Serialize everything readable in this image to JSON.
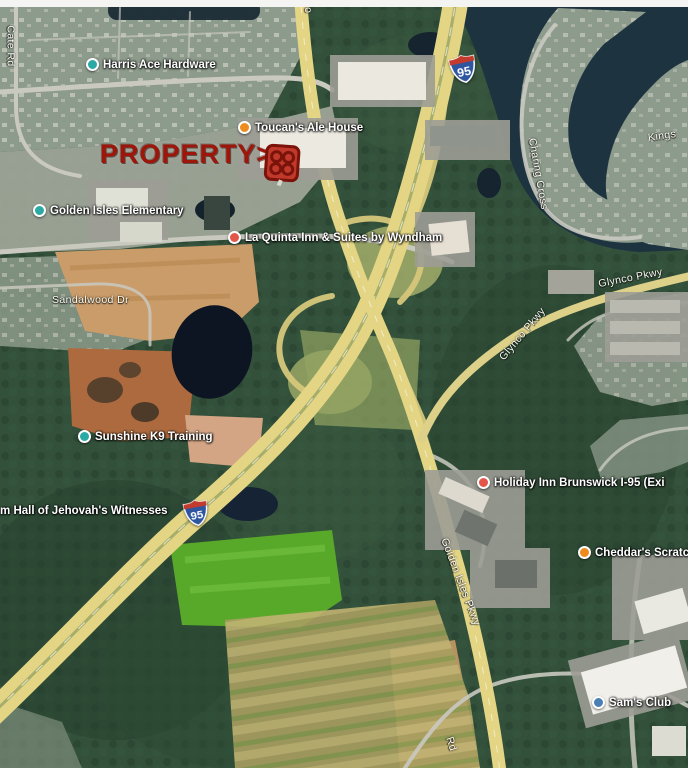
{
  "map_type": "satellite-aerial",
  "annotation": {
    "property_label": "PROPERTY>",
    "marker_icon": "red-pinwheel-badge"
  },
  "shield": {
    "route": "95",
    "icon": "interstate-shield"
  },
  "poi": [
    {
      "name": "Harris Ace Hardware",
      "icon": "teal-dot-icon"
    },
    {
      "name": "Toucan's Ale House",
      "icon": "orange-restaurant-dot-icon"
    },
    {
      "name": "Golden Isles Elementary",
      "icon": "teal-dot-icon"
    },
    {
      "name": "La Quinta Inn & Suites by Wyndham",
      "icon": "red-hotel-dot-icon"
    },
    {
      "name": "Sunshine K9 Training",
      "icon": "teal-dot-icon"
    },
    {
      "name": "Holiday Inn Brunswick I-95 (Exi",
      "icon": "red-hotel-dot-icon"
    },
    {
      "name": "dom Hall of Jehovah's Witnesses",
      "icon": "none"
    },
    {
      "name": "Cheddar's Scratc",
      "icon": "orange-restaurant-dot-icon"
    },
    {
      "name": "Sam's Club",
      "icon": "blue-store-dot-icon"
    }
  ],
  "roads": [
    {
      "name": "Cate Rd"
    },
    {
      "name": "Go"
    },
    {
      "name": "Sandalwood Dr"
    },
    {
      "name": "Charing Cross"
    },
    {
      "name": "Kings"
    },
    {
      "name": "Glynco Pkwy"
    },
    {
      "name": "Glynco Pkwy"
    },
    {
      "name": "Golden Isles Pkwy"
    },
    {
      "name": "Rd"
    }
  ],
  "colors": {
    "forest_green": "#33503a",
    "water_navy": "#1d3340",
    "highway_yellow": "#e3d584",
    "property_red": "#9e150a",
    "marker_red": "#c0392b",
    "shield_blue": "#2d55a0",
    "shield_red": "#c23b2e",
    "poi_teal": "#2ba9a4",
    "poi_orange": "#ef8b1d",
    "poi_hotel_red": "#e4564a",
    "poi_blue": "#4a7fb5"
  }
}
